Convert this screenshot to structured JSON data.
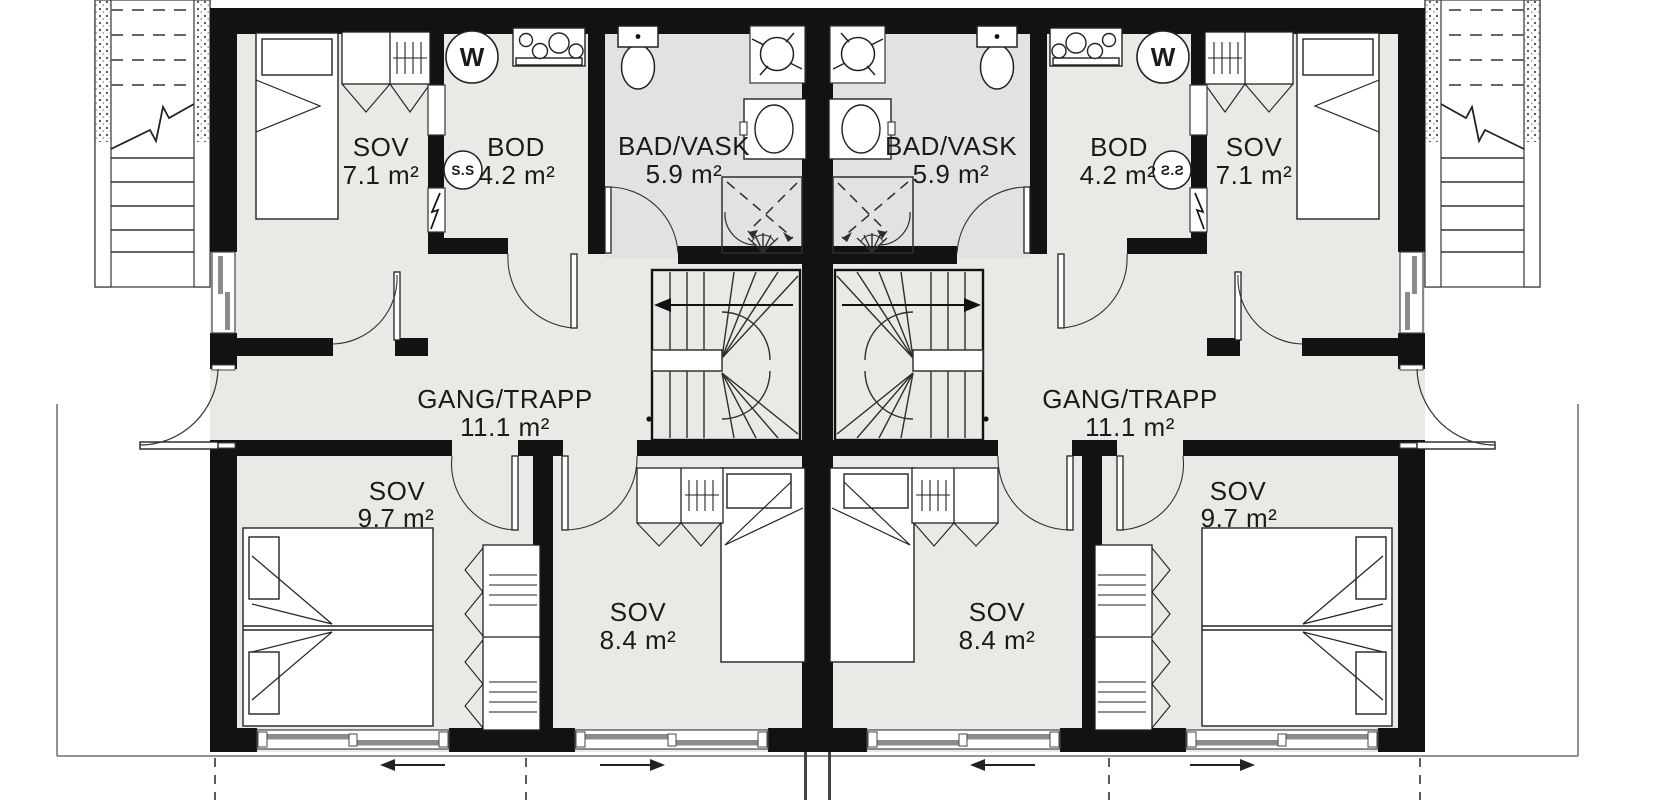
{
  "colors": {
    "wall": "#121212",
    "thin_line": "#2e2e2e",
    "room_fill": "#eae9e5",
    "wet_room_fill": "#e2e3e0",
    "furniture_fill": "#ffffff",
    "sash_gray": "#8c8c8c",
    "text": "#1a1a1a"
  },
  "units": {
    "left": {
      "rooms": [
        {
          "name": "SOV",
          "area": "7.1 m²"
        },
        {
          "name": "BOD",
          "area": "4.2 m²"
        },
        {
          "name": "BAD/VASK",
          "area": "5.9 m²"
        },
        {
          "name": "GANG/TRAPP",
          "area": "11.1 m²"
        },
        {
          "name": "SOV",
          "area": "9.7 m²"
        },
        {
          "name": "SOV",
          "area": "8.4 m²"
        }
      ],
      "icons": {
        "water_heater": "W",
        "fuse_cabinet": "S.S"
      }
    },
    "right": {
      "rooms": [
        {
          "name": "SOV",
          "area": "7.1 m²"
        },
        {
          "name": "BOD",
          "area": "4.2 m²"
        },
        {
          "name": "BAD/VASK",
          "area": "5.9 m²"
        },
        {
          "name": "GANG/TRAPP",
          "area": "11.1 m²"
        },
        {
          "name": "SOV",
          "area": "9.7 m²"
        },
        {
          "name": "SOV",
          "area": "8.4 m²"
        }
      ],
      "icons": {
        "water_heater": "W",
        "fuse_cabinet": "S.S"
      }
    }
  }
}
